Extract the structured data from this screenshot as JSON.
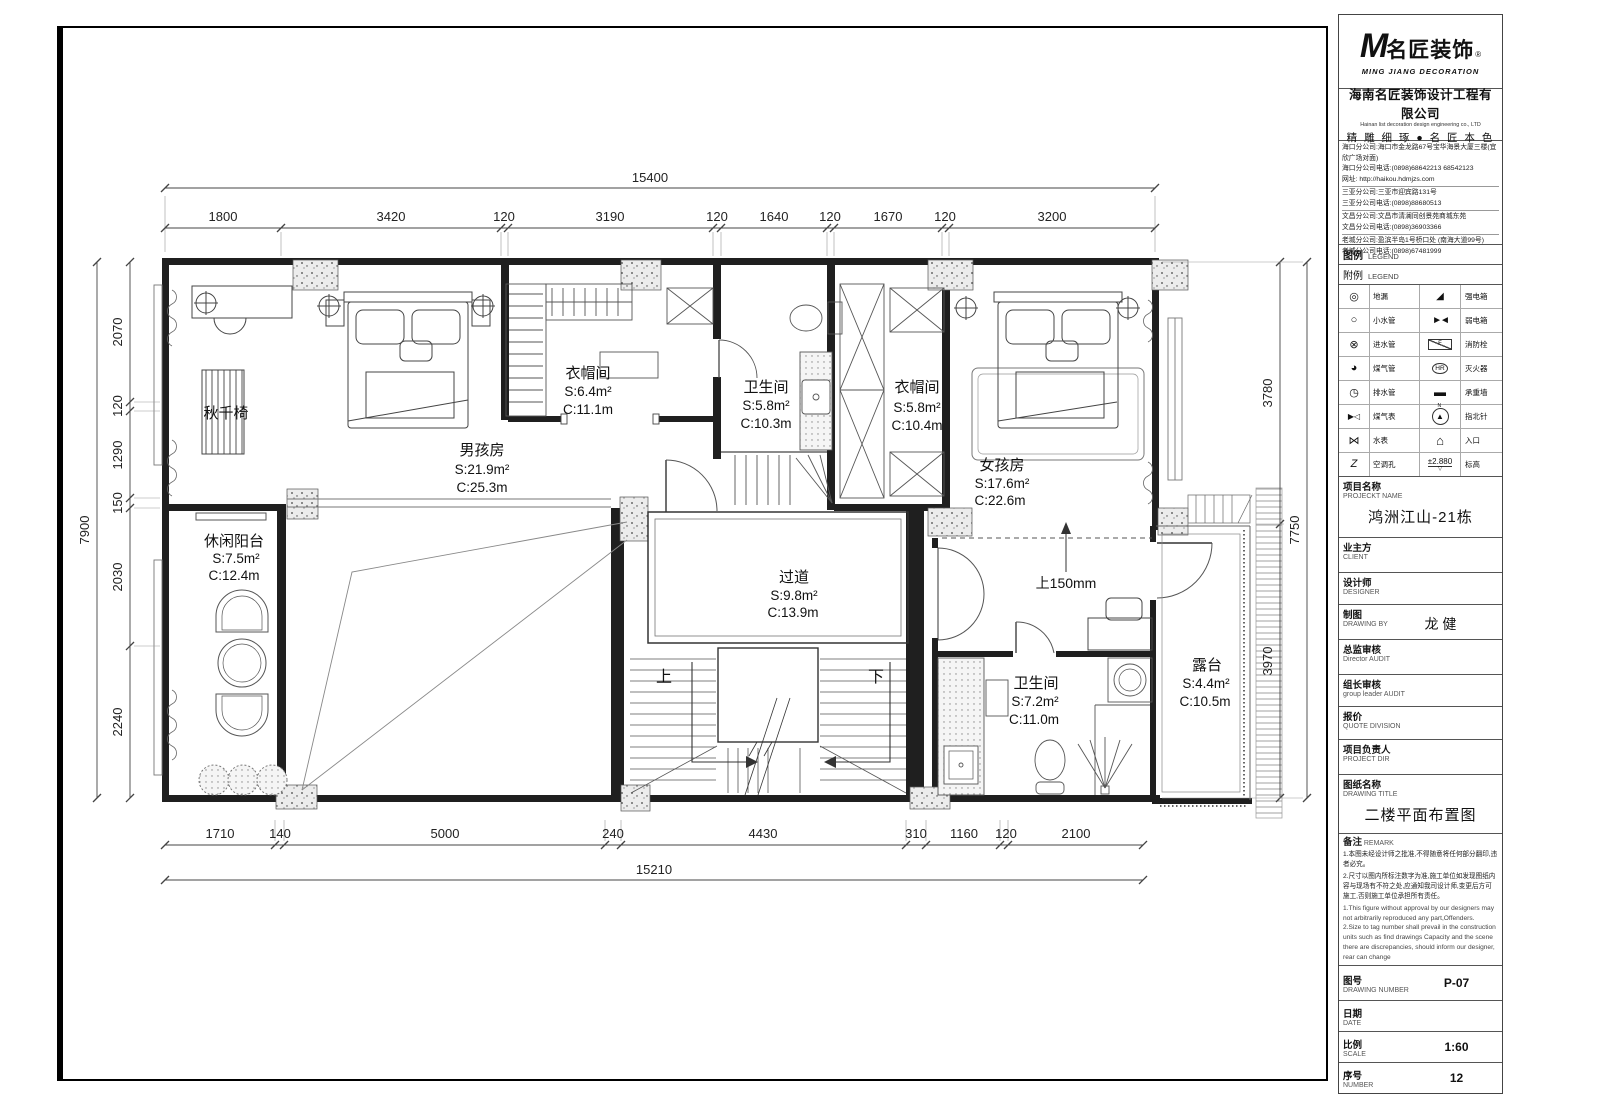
{
  "tb": {
    "brand": {
      "m": "M",
      "cn": "名匠装饰",
      "reg": "®",
      "en": "MING JIANG DECORATION"
    },
    "company_cn": "海南名匠装饰设计工程有限公司",
    "company_en": "Hainan list decoration design engineering co., LTD",
    "slogan": "精 雕 细 琢 ● 名 匠 本 色",
    "contacts": [
      "海口分公司:海口市金龙路67号宝华海景大厦三楼(宜欣广场对面)",
      "海口分公司电话:(0898)68642213 68542123",
      "网址: http://haikou.hdmjzs.com",
      "三亚分公司:三亚市迎宾路131号",
      "三亚分公司电话:(0898)88680513",
      "文昌分公司:文昌市清澜同创景苑商城东苑",
      "文昌分公司电话:(0898)36903366",
      "老城分公司:盈滨半岛1号桥口处 (南海大道99号)",
      "老城分公司电话:(0898)67481999"
    ],
    "legend_cn": "图例",
    "legend_en": "LEGEND",
    "legend2_cn": "附例",
    "legend2_en": "LEGEND",
    "legend_rows": [
      {
        "li": "◎",
        "ll": "地漏",
        "ri": "◢",
        "rl": "强电箱"
      },
      {
        "li": "○",
        "ll": "小水管",
        "ri": "►◄",
        "rl": "弱电箱"
      },
      {
        "li": "⊗",
        "ll": "进水管",
        "ri": "F",
        "rl": "消防栓"
      },
      {
        "li": "◕",
        "ll": "煤气管",
        "ri": "HR",
        "rl": "灭火器"
      },
      {
        "li": "◷",
        "ll": "排水管",
        "ri": "▬",
        "rl": "承重墙"
      },
      {
        "li": "▶◁",
        "ll": "煤气表",
        "ri": "▲",
        "ri2": "N",
        "rl": "指北针"
      },
      {
        "li": "⋈",
        "ll": "水表",
        "ri": "⌂",
        "rl": "入口"
      },
      {
        "li": "Z",
        "ll": "空调孔",
        "ri": "±2.880",
        "ri2": "▽",
        "rl": "标高"
      }
    ],
    "fields": [
      {
        "cn": "项目名称",
        "en": "PROJECKT NAME",
        "value": "鸿洲江山-21栋"
      },
      {
        "cn": "业主方",
        "en": "CLIENT",
        "value": ""
      },
      {
        "cn": "设计师",
        "en": "DESIGNER",
        "value": ""
      },
      {
        "cn": "制图",
        "en": "DRAWING BY",
        "value": "龙 健"
      },
      {
        "cn": "总监审核",
        "en": "Director AUDIT",
        "value": ""
      },
      {
        "cn": "组长审核",
        "en": "group leader AUDIT",
        "value": ""
      },
      {
        "cn": "报价",
        "en": "QUOTE DIVISION",
        "value": ""
      },
      {
        "cn": "项目负责人",
        "en": "PROJECT DIR",
        "value": ""
      },
      {
        "cn": "图纸名称",
        "en": "DRAWING TITLE",
        "value": "二楼平面布置图"
      }
    ],
    "remark_cn": "备注",
    "remark_en": "REMARK",
    "remark_cn_lines": [
      "1.本图未经设计师之批准,不得随意将任何部分翻印,违者必究。",
      "2.尺寸以图内所标注数字为准,施工单位如发现图纸内容与现场有不符之处,应通知我司设计师,变更后方可施工,否则施工单位承担所有责任。"
    ],
    "remark_en_lines": [
      "1.This figure without approval by our designers may not arbitrarily reproduced any part,Offenders.",
      "2.Size to tag number shall prevail in the construction units such as find drawings Capacity and the scene there are discrepancies, should inform our designer, rear can change"
    ],
    "footer": [
      {
        "cn": "图号",
        "en": "DRAWING NUMBER",
        "value": "P-07"
      },
      {
        "cn": "日期",
        "en": "DATE",
        "value": ""
      },
      {
        "cn": "比例",
        "en": "SCALE",
        "value": "1:60"
      },
      {
        "cn": "序号",
        "en": "NUMBER",
        "value": "12"
      }
    ]
  },
  "plan": {
    "rooms": [
      {
        "name": "男孩房",
        "s": "S:21.9m²",
        "c": "C:25.3m"
      },
      {
        "name": "衣帽间",
        "s": "S:6.4m²",
        "c": "C:11.1m"
      },
      {
        "name": "卫生间",
        "s": "S:5.8m²",
        "c": "C:10.3m"
      },
      {
        "name": "衣帽间",
        "s": "S:5.8m²",
        "c": "C:10.4m"
      },
      {
        "name": "女孩房",
        "s": "S:17.6m²",
        "c": "C:22.6m"
      },
      {
        "name": "休闲阳台",
        "s": "S:7.5m²",
        "c": "C:12.4m"
      },
      {
        "name": "过道",
        "s": "S:9.8m²",
        "c": "C:13.9m"
      },
      {
        "name": "卫生间",
        "s": "S:7.2m²",
        "c": "C:11.0m"
      },
      {
        "name": "露台",
        "s": "S:4.4m²",
        "c": "C:10.5m"
      }
    ],
    "annotations": {
      "swing_chair": "秋千椅",
      "step_up": "上150mm",
      "stair_up": "上",
      "stair_down": "下"
    },
    "dims": {
      "top_overall": "15400",
      "top": [
        "1800",
        "3420",
        "120",
        "3190",
        "120",
        "1640",
        "120",
        "1670",
        "120",
        "3200"
      ],
      "bottom": [
        "1710",
        "140",
        "5000",
        "240",
        "4430",
        "310",
        "1160",
        "120",
        "2100"
      ],
      "bottom_overall": "15210",
      "left": [
        "2070",
        "120",
        "1290",
        "150",
        "2030",
        "2240"
      ],
      "left_overall": "7900",
      "right": [
        "3780",
        "3970"
      ],
      "right_overall": "7750"
    }
  }
}
